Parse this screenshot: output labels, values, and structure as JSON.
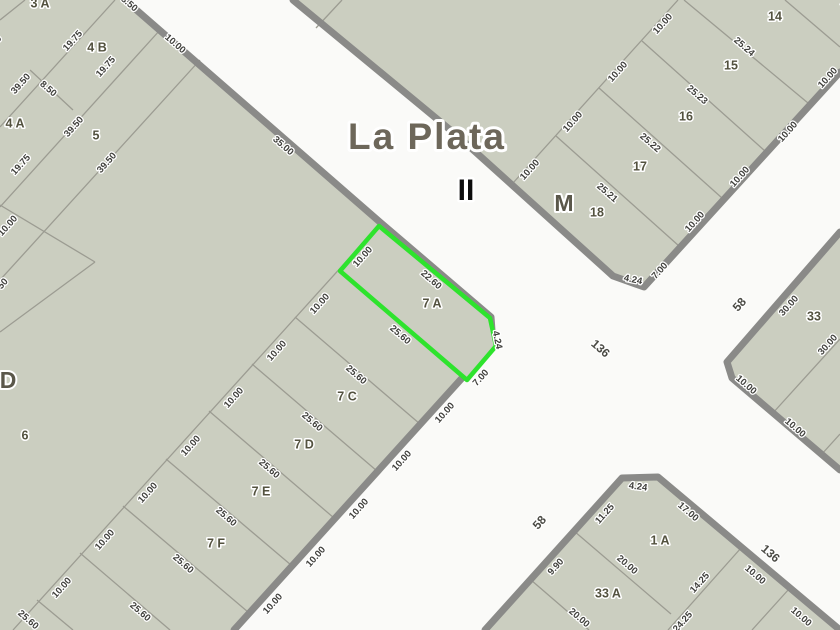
{
  "map": {
    "city_label": "La Plata",
    "section_label": "II",
    "colors": {
      "road": "#fafaf8",
      "parcel_fill": "#cbcec0",
      "casing": "#8a8a88",
      "parcel_line": "#9c9c92",
      "highlight": "#2ee32d",
      "dim_text": "#3f3f3b",
      "name_text": "#53523f",
      "title_text": "#6d675a"
    },
    "highlight_parcel": {
      "name": "parcel-7a-highlight",
      "label": "7 A",
      "points": "379,226 490,318 496,346 467,380 340,271"
    },
    "blocks": [
      {
        "name": "block-west",
        "points": "0,0 125,0 381,223 491,317 493,344 463,377 234,630 0,630"
      },
      {
        "name": "block-north",
        "points": "293,0 460,138 613,276 644,287 840,72 840,0"
      },
      {
        "name": "block-east",
        "points": "840,232 727,362 732,378 840,470"
      },
      {
        "name": "block-south",
        "points": "485,630 622,478 658,477 840,630"
      }
    ],
    "casings": [
      {
        "name": "road-edge-west",
        "points": "125,0 381,223 491,317 493,344 463,377 234,630"
      },
      {
        "name": "road-edge-north",
        "points": "293,0 460,138 613,276 644,287 840,72"
      },
      {
        "name": "road-edge-east",
        "points": "840,232 727,362 732,378 840,470"
      },
      {
        "name": "road-edge-south",
        "points": "485,630 622,478 658,477 840,630"
      }
    ],
    "parcel_lines": [
      {
        "x1": 25,
        "y1": 0,
        "x2": 0,
        "y2": 20
      },
      {
        "x1": 115,
        "y1": 0,
        "x2": 0,
        "y2": 127
      },
      {
        "x1": 160,
        "y1": 30,
        "x2": 0,
        "y2": 207
      },
      {
        "x1": 30,
        "y1": 70,
        "x2": 73,
        "y2": 110
      },
      {
        "x1": 200,
        "y1": 60,
        "x2": 0,
        "y2": 280
      },
      {
        "x1": 0,
        "y1": 205,
        "x2": 95,
        "y2": 262
      },
      {
        "x1": 95,
        "y1": 262,
        "x2": 0,
        "y2": 332
      },
      {
        "x1": 381,
        "y1": 223,
        "x2": 13,
        "y2": 630
      },
      {
        "x1": 295,
        "y1": 317,
        "x2": 420,
        "y2": 424
      },
      {
        "x1": 252,
        "y1": 364,
        "x2": 377,
        "y2": 471
      },
      {
        "x1": 209,
        "y1": 411,
        "x2": 334,
        "y2": 518
      },
      {
        "x1": 166,
        "y1": 459,
        "x2": 291,
        "y2": 565
      },
      {
        "x1": 123,
        "y1": 506,
        "x2": 248,
        "y2": 612
      },
      {
        "x1": 80,
        "y1": 553,
        "x2": 170,
        "y2": 630
      },
      {
        "x1": 37,
        "y1": 600,
        "x2": 73,
        "y2": 630
      },
      {
        "x1": 513,
        "y1": 183,
        "x2": 678,
        "y2": 0
      },
      {
        "x1": 556,
        "y1": 136,
        "x2": 679,
        "y2": 246
      },
      {
        "x1": 599,
        "y1": 88,
        "x2": 722,
        "y2": 198
      },
      {
        "x1": 642,
        "y1": 41,
        "x2": 765,
        "y2": 151
      },
      {
        "x1": 684,
        "y1": 0,
        "x2": 808,
        "y2": 103
      },
      {
        "x1": 785,
        "y1": 0,
        "x2": 840,
        "y2": 47
      },
      {
        "x1": 342,
        "y1": 0,
        "x2": 316,
        "y2": 28
      },
      {
        "x1": 772,
        "y1": 414,
        "x2": 840,
        "y2": 339
      },
      {
        "x1": 821,
        "y1": 455,
        "x2": 840,
        "y2": 434
      },
      {
        "x1": 574,
        "y1": 531,
        "x2": 671,
        "y2": 614
      },
      {
        "x1": 741,
        "y1": 548,
        "x2": 668,
        "y2": 630
      },
      {
        "x1": 789,
        "y1": 589,
        "x2": 752,
        "y2": 630
      },
      {
        "x1": 531,
        "y1": 580,
        "x2": 589,
        "y2": 630
      }
    ],
    "labels": [
      {
        "t": "La Plata",
        "x": 427,
        "y": 139,
        "r": 0,
        "s": "title",
        "name": "city-title"
      },
      {
        "t": "II",
        "x": 466,
        "y": 192,
        "r": 0,
        "s": "sect",
        "name": "section-label"
      },
      {
        "t": "M",
        "x": 564,
        "y": 205,
        "r": 0,
        "s": "blk",
        "name": "block-letter-m"
      },
      {
        "t": "D",
        "x": 8,
        "y": 382,
        "r": 0,
        "s": "blk",
        "name": "block-letter-d"
      },
      {
        "t": "58",
        "x": 740,
        "y": 305,
        "r": -48,
        "s": "street",
        "name": "street-58"
      },
      {
        "t": "58",
        "x": 540,
        "y": 523,
        "r": -48,
        "s": "street",
        "name": "street-58"
      },
      {
        "t": "136",
        "x": 600,
        "y": 349,
        "r": 41,
        "s": "street",
        "name": "street-136"
      },
      {
        "t": "136",
        "x": 770,
        "y": 554,
        "r": 41,
        "s": "street",
        "name": "street-136"
      },
      {
        "t": "3 A",
        "x": 40,
        "y": 4,
        "r": 0,
        "s": "name",
        "name": "parcel-label"
      },
      {
        "t": "4 B",
        "x": 97,
        "y": 48,
        "r": 0,
        "s": "name",
        "name": "parcel-label"
      },
      {
        "t": "4 A",
        "x": 15,
        "y": 124,
        "r": 0,
        "s": "name",
        "name": "parcel-label"
      },
      {
        "t": "5",
        "x": 96,
        "y": 136,
        "r": 0,
        "s": "name",
        "name": "parcel-label"
      },
      {
        "t": "6",
        "x": 25,
        "y": 436,
        "r": 0,
        "s": "name",
        "name": "parcel-label"
      },
      {
        "t": "7 A",
        "x": 432,
        "y": 304,
        "r": 0,
        "s": "name",
        "name": "parcel-label"
      },
      {
        "t": "7 C",
        "x": 347,
        "y": 397,
        "r": 0,
        "s": "name",
        "name": "parcel-label"
      },
      {
        "t": "7 D",
        "x": 304,
        "y": 445,
        "r": 0,
        "s": "name",
        "name": "parcel-label"
      },
      {
        "t": "7 E",
        "x": 261,
        "y": 492,
        "r": 0,
        "s": "name",
        "name": "parcel-label"
      },
      {
        "t": "7 F",
        "x": 216,
        "y": 544,
        "r": 0,
        "s": "name",
        "name": "parcel-label"
      },
      {
        "t": "14",
        "x": 775,
        "y": 17,
        "r": 0,
        "s": "name",
        "name": "parcel-label"
      },
      {
        "t": "15",
        "x": 731,
        "y": 66,
        "r": 0,
        "s": "name",
        "name": "parcel-label"
      },
      {
        "t": "16",
        "x": 686,
        "y": 117,
        "r": 0,
        "s": "name",
        "name": "parcel-label"
      },
      {
        "t": "17",
        "x": 640,
        "y": 167,
        "r": 0,
        "s": "name",
        "name": "parcel-label"
      },
      {
        "t": "18",
        "x": 597,
        "y": 213,
        "r": 0,
        "s": "name",
        "name": "parcel-label"
      },
      {
        "t": "33",
        "x": 814,
        "y": 317,
        "r": 0,
        "s": "name",
        "name": "parcel-label"
      },
      {
        "t": "1 A",
        "x": 660,
        "y": 541,
        "r": 0,
        "s": "name",
        "name": "parcel-label"
      },
      {
        "t": "33 A",
        "x": 608,
        "y": 594,
        "r": 0,
        "s": "name",
        "name": "parcel-label"
      },
      {
        "t": "8.50",
        "x": 129,
        "y": 4,
        "r": 41,
        "s": "dim",
        "name": "dimension-label"
      },
      {
        "t": "10.00",
        "x": 175,
        "y": 44,
        "r": 41,
        "s": "dim",
        "name": "dimension-label"
      },
      {
        "t": "35.00",
        "x": 283,
        "y": 146,
        "r": 41,
        "s": "dim",
        "name": "dimension-label"
      },
      {
        "t": "19.75",
        "x": 73,
        "y": 41,
        "r": -48,
        "s": "dim",
        "name": "dimension-label"
      },
      {
        "t": "19.75",
        "x": 106,
        "y": 67,
        "r": -48,
        "s": "dim",
        "name": "dimension-label"
      },
      {
        "t": "8.50",
        "x": 48,
        "y": 89,
        "r": 41,
        "s": "dim",
        "name": "dimension-label"
      },
      {
        "t": "39.50",
        "x": 21,
        "y": 84,
        "r": -48,
        "s": "dim",
        "name": "dimension-label"
      },
      {
        "t": "39.50",
        "x": 74,
        "y": 127,
        "r": -48,
        "s": "dim",
        "name": "dimension-label"
      },
      {
        "t": "39.50",
        "x": 107,
        "y": 163,
        "r": -48,
        "s": "dim",
        "name": "dimension-label"
      },
      {
        "t": "19.75",
        "x": 21,
        "y": 165,
        "r": -48,
        "s": "dim",
        "name": "dimension-label"
      },
      {
        "t": "8.70",
        "x": -6,
        "y": 44,
        "r": -48,
        "s": "dim",
        "name": "dimension-label"
      },
      {
        "t": "10.00",
        "x": 8,
        "y": 226,
        "r": -48,
        "s": "dim",
        "name": "dimension-label"
      },
      {
        "t": "50",
        "x": 3,
        "y": 284,
        "r": -48,
        "s": "dim",
        "name": "dimension-label"
      },
      {
        "t": "10.00",
        "x": 363,
        "y": 257,
        "r": -48,
        "s": "dim",
        "name": "dimension-label"
      },
      {
        "t": "10.00",
        "x": 320,
        "y": 304,
        "r": -48,
        "s": "dim",
        "name": "dimension-label"
      },
      {
        "t": "10.00",
        "x": 277,
        "y": 351,
        "r": -48,
        "s": "dim",
        "name": "dimension-label"
      },
      {
        "t": "10.00",
        "x": 234,
        "y": 398,
        "r": -48,
        "s": "dim",
        "name": "dimension-label"
      },
      {
        "t": "10.00",
        "x": 191,
        "y": 446,
        "r": -48,
        "s": "dim",
        "name": "dimension-label"
      },
      {
        "t": "10.00",
        "x": 148,
        "y": 493,
        "r": -48,
        "s": "dim",
        "name": "dimension-label"
      },
      {
        "t": "10.00",
        "x": 105,
        "y": 540,
        "r": -48,
        "s": "dim",
        "name": "dimension-label"
      },
      {
        "t": "10.00",
        "x": 62,
        "y": 588,
        "r": -48,
        "s": "dim",
        "name": "dimension-label"
      },
      {
        "t": "22.60",
        "x": 431,
        "y": 280,
        "r": 41,
        "s": "dim",
        "name": "dimension-label"
      },
      {
        "t": "25.60",
        "x": 400,
        "y": 335,
        "r": 41,
        "s": "dim",
        "name": "dimension-label"
      },
      {
        "t": "25.60",
        "x": 356,
        "y": 375,
        "r": 41,
        "s": "dim",
        "name": "dimension-label"
      },
      {
        "t": "25.60",
        "x": 312,
        "y": 422,
        "r": 41,
        "s": "dim",
        "name": "dimension-label"
      },
      {
        "t": "25.60",
        "x": 269,
        "y": 469,
        "r": 41,
        "s": "dim",
        "name": "dimension-label"
      },
      {
        "t": "25.60",
        "x": 226,
        "y": 517,
        "r": 41,
        "s": "dim",
        "name": "dimension-label"
      },
      {
        "t": "25.60",
        "x": 183,
        "y": 564,
        "r": 41,
        "s": "dim",
        "name": "dimension-label"
      },
      {
        "t": "25.60",
        "x": 140,
        "y": 612,
        "r": 41,
        "s": "dim",
        "name": "dimension-label"
      },
      {
        "t": "25.60",
        "x": 28,
        "y": 620,
        "r": 41,
        "s": "dim",
        "name": "dimension-label"
      },
      {
        "t": "4.24",
        "x": 497,
        "y": 340,
        "r": 78,
        "s": "dim",
        "name": "dimension-label"
      },
      {
        "t": "7.00",
        "x": 481,
        "y": 378,
        "r": -48,
        "s": "dim",
        "name": "dimension-label"
      },
      {
        "t": "10.00",
        "x": 445,
        "y": 413,
        "r": -48,
        "s": "dim",
        "name": "dimension-label"
      },
      {
        "t": "10.00",
        "x": 402,
        "y": 461,
        "r": -48,
        "s": "dim",
        "name": "dimension-label"
      },
      {
        "t": "10.00",
        "x": 359,
        "y": 509,
        "r": -48,
        "s": "dim",
        "name": "dimension-label"
      },
      {
        "t": "10.00",
        "x": 316,
        "y": 557,
        "r": -48,
        "s": "dim",
        "name": "dimension-label"
      },
      {
        "t": "10.00",
        "x": 273,
        "y": 604,
        "r": -48,
        "s": "dim",
        "name": "dimension-label"
      },
      {
        "t": "10.00",
        "x": 530,
        "y": 170,
        "r": -48,
        "s": "dim",
        "name": "dimension-label"
      },
      {
        "t": "10.00",
        "x": 573,
        "y": 122,
        "r": -48,
        "s": "dim",
        "name": "dimension-label"
      },
      {
        "t": "10.00",
        "x": 618,
        "y": 72,
        "r": -48,
        "s": "dim",
        "name": "dimension-label"
      },
      {
        "t": "10.00",
        "x": 663,
        "y": 24,
        "r": -48,
        "s": "dim",
        "name": "dimension-label"
      },
      {
        "t": "25.21",
        "x": 607,
        "y": 193,
        "r": 41,
        "s": "dim",
        "name": "dimension-label"
      },
      {
        "t": "25.22",
        "x": 650,
        "y": 143,
        "r": 41,
        "s": "dim",
        "name": "dimension-label"
      },
      {
        "t": "25.23",
        "x": 697,
        "y": 95,
        "r": 41,
        "s": "dim",
        "name": "dimension-label"
      },
      {
        "t": "25.24",
        "x": 744,
        "y": 47,
        "r": 41,
        "s": "dim",
        "name": "dimension-label"
      },
      {
        "t": "25.25",
        "x": 851,
        "y": 10,
        "r": 41,
        "s": "dim",
        "name": "dimension-label"
      },
      {
        "t": "10.00",
        "x": 695,
        "y": 222,
        "r": -48,
        "s": "dim",
        "name": "dimension-label"
      },
      {
        "t": "10.00",
        "x": 740,
        "y": 177,
        "r": -48,
        "s": "dim",
        "name": "dimension-label"
      },
      {
        "t": "10.00",
        "x": 788,
        "y": 132,
        "r": -48,
        "s": "dim",
        "name": "dimension-label"
      },
      {
        "t": "10.00",
        "x": 828,
        "y": 78,
        "r": -48,
        "s": "dim",
        "name": "dimension-label"
      },
      {
        "t": "4.24",
        "x": 633,
        "y": 280,
        "r": 12,
        "s": "dim",
        "name": "dimension-label"
      },
      {
        "t": "7.00",
        "x": 660,
        "y": 271,
        "r": -48,
        "s": "dim",
        "name": "dimension-label"
      },
      {
        "t": "30.00",
        "x": 789,
        "y": 306,
        "r": -48,
        "s": "dim",
        "name": "dimension-label"
      },
      {
        "t": "30.00",
        "x": 828,
        "y": 345,
        "r": -48,
        "s": "dim",
        "name": "dimension-label"
      },
      {
        "t": "10.00",
        "x": 746,
        "y": 385,
        "r": 41,
        "s": "dim",
        "name": "dimension-label"
      },
      {
        "t": "10.00",
        "x": 795,
        "y": 428,
        "r": 41,
        "s": "dim",
        "name": "dimension-label"
      },
      {
        "t": "4.24",
        "x": 638,
        "y": 487,
        "r": 8,
        "s": "dim",
        "name": "dimension-label"
      },
      {
        "t": "11.25",
        "x": 605,
        "y": 514,
        "r": -48,
        "s": "dim",
        "name": "dimension-label"
      },
      {
        "t": "9.90",
        "x": 556,
        "y": 567,
        "r": -48,
        "s": "dim",
        "name": "dimension-label"
      },
      {
        "t": "17.00",
        "x": 688,
        "y": 512,
        "r": 41,
        "s": "dim",
        "name": "dimension-label"
      },
      {
        "t": "20.00",
        "x": 627,
        "y": 565,
        "r": 41,
        "s": "dim",
        "name": "dimension-label"
      },
      {
        "t": "20.00",
        "x": 579,
        "y": 618,
        "r": 41,
        "s": "dim",
        "name": "dimension-label"
      },
      {
        "t": "14.25",
        "x": 700,
        "y": 583,
        "r": -48,
        "s": "dim",
        "name": "dimension-label"
      },
      {
        "t": "24.25",
        "x": 683,
        "y": 622,
        "r": -48,
        "s": "dim",
        "name": "dimension-label"
      },
      {
        "t": "10.00",
        "x": 755,
        "y": 575,
        "r": 41,
        "s": "dim",
        "name": "dimension-label"
      },
      {
        "t": "10.00",
        "x": 801,
        "y": 617,
        "r": 41,
        "s": "dim",
        "name": "dimension-label"
      }
    ]
  }
}
